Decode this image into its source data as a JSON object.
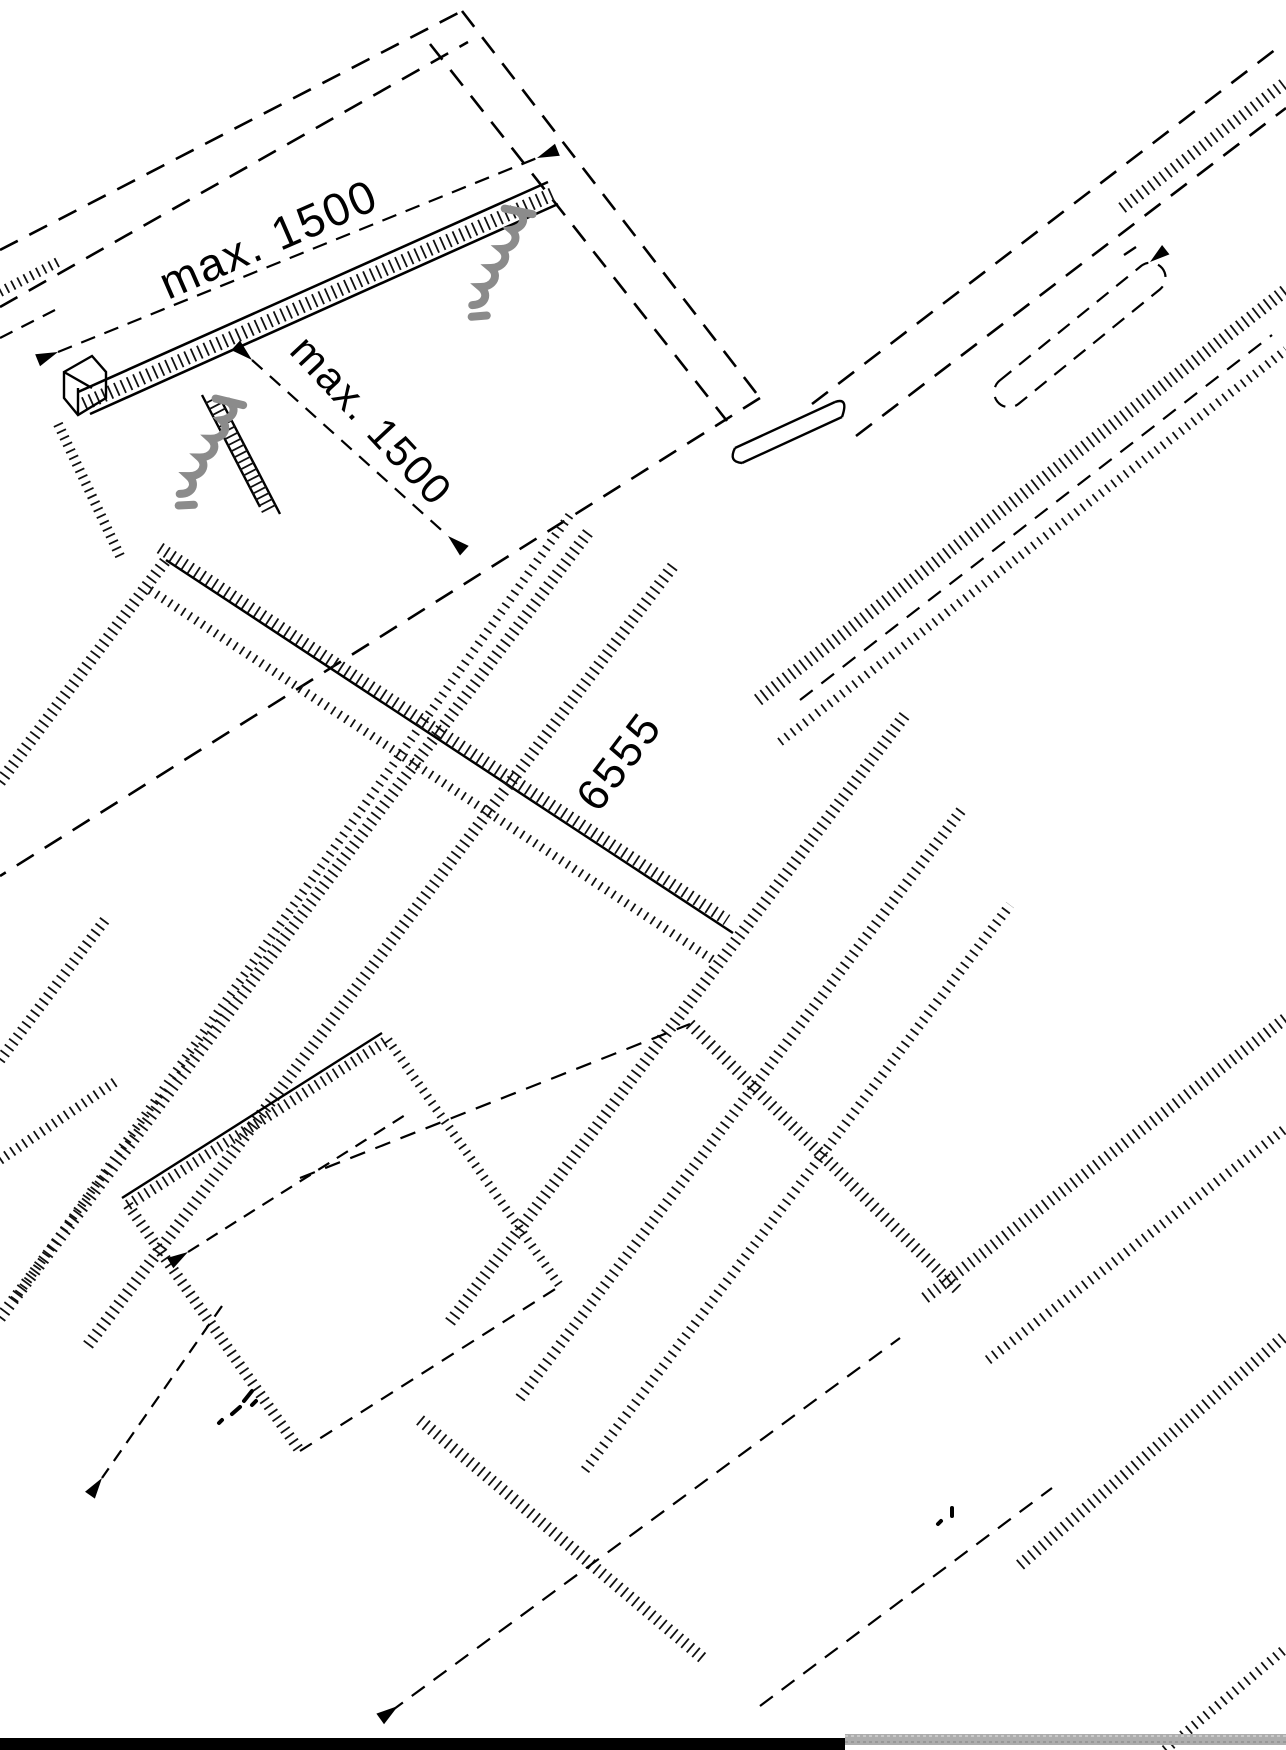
{
  "canvas": {
    "background": "#ffffff",
    "line_color": "#000000"
  },
  "labels": {
    "bracket_spacing_top": "max. 1500",
    "bracket_spacing_side": "max. 1500",
    "length_dimension": "6555"
  },
  "icons": {
    "screw_top": "screw-icon",
    "screw_left": "screw-icon",
    "color": "#8b8b8b"
  },
  "footer": {
    "black_bar_color": "#000000",
    "gray_bar_color": "#adadad"
  }
}
